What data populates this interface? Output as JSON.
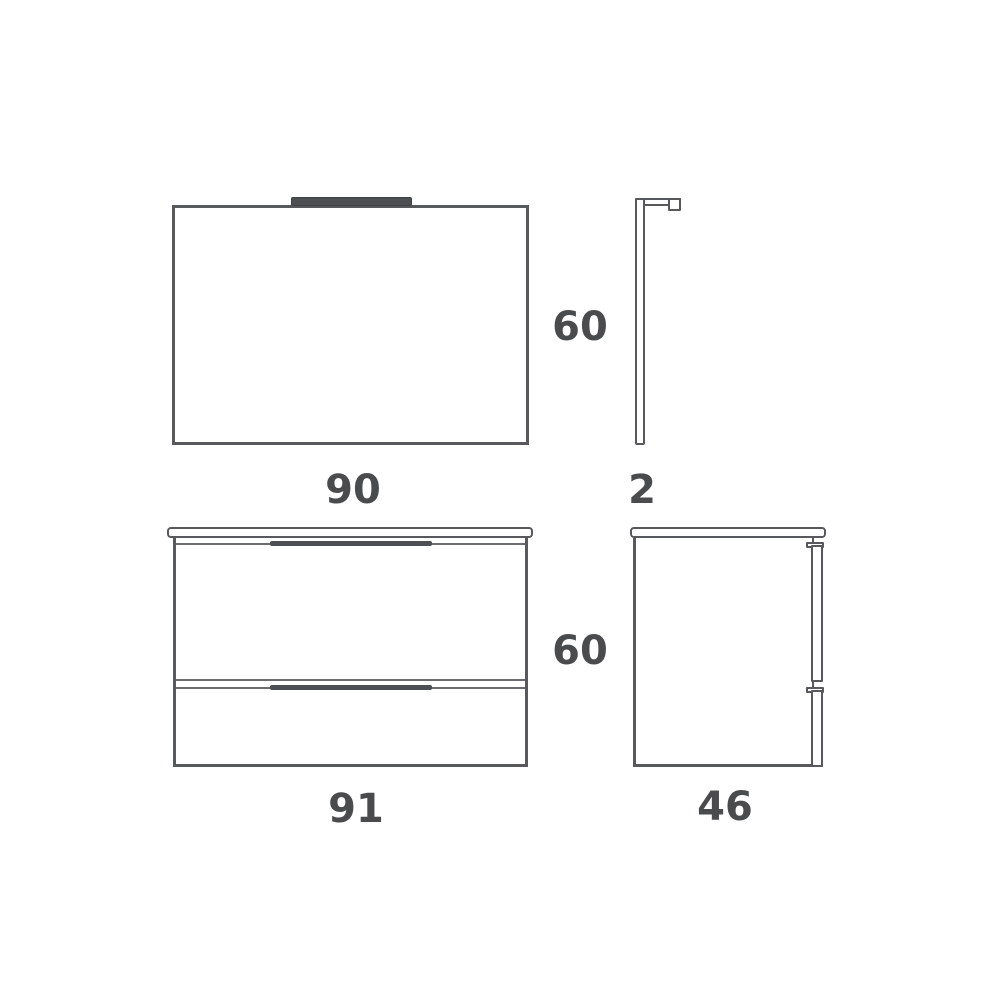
{
  "page": {
    "background_color": "#ffffff",
    "line_color": "#57595c",
    "dark_fill_color": "#4d4f52",
    "text_color": "#4a4b4d"
  },
  "diagram": {
    "mirror_front": {
      "width_label": "90",
      "height_label": "60"
    },
    "mirror_side": {
      "depth_label": "2"
    },
    "vanity_front": {
      "width_label": "91",
      "height_label": "60"
    },
    "vanity_side": {
      "depth_label": "46"
    }
  }
}
